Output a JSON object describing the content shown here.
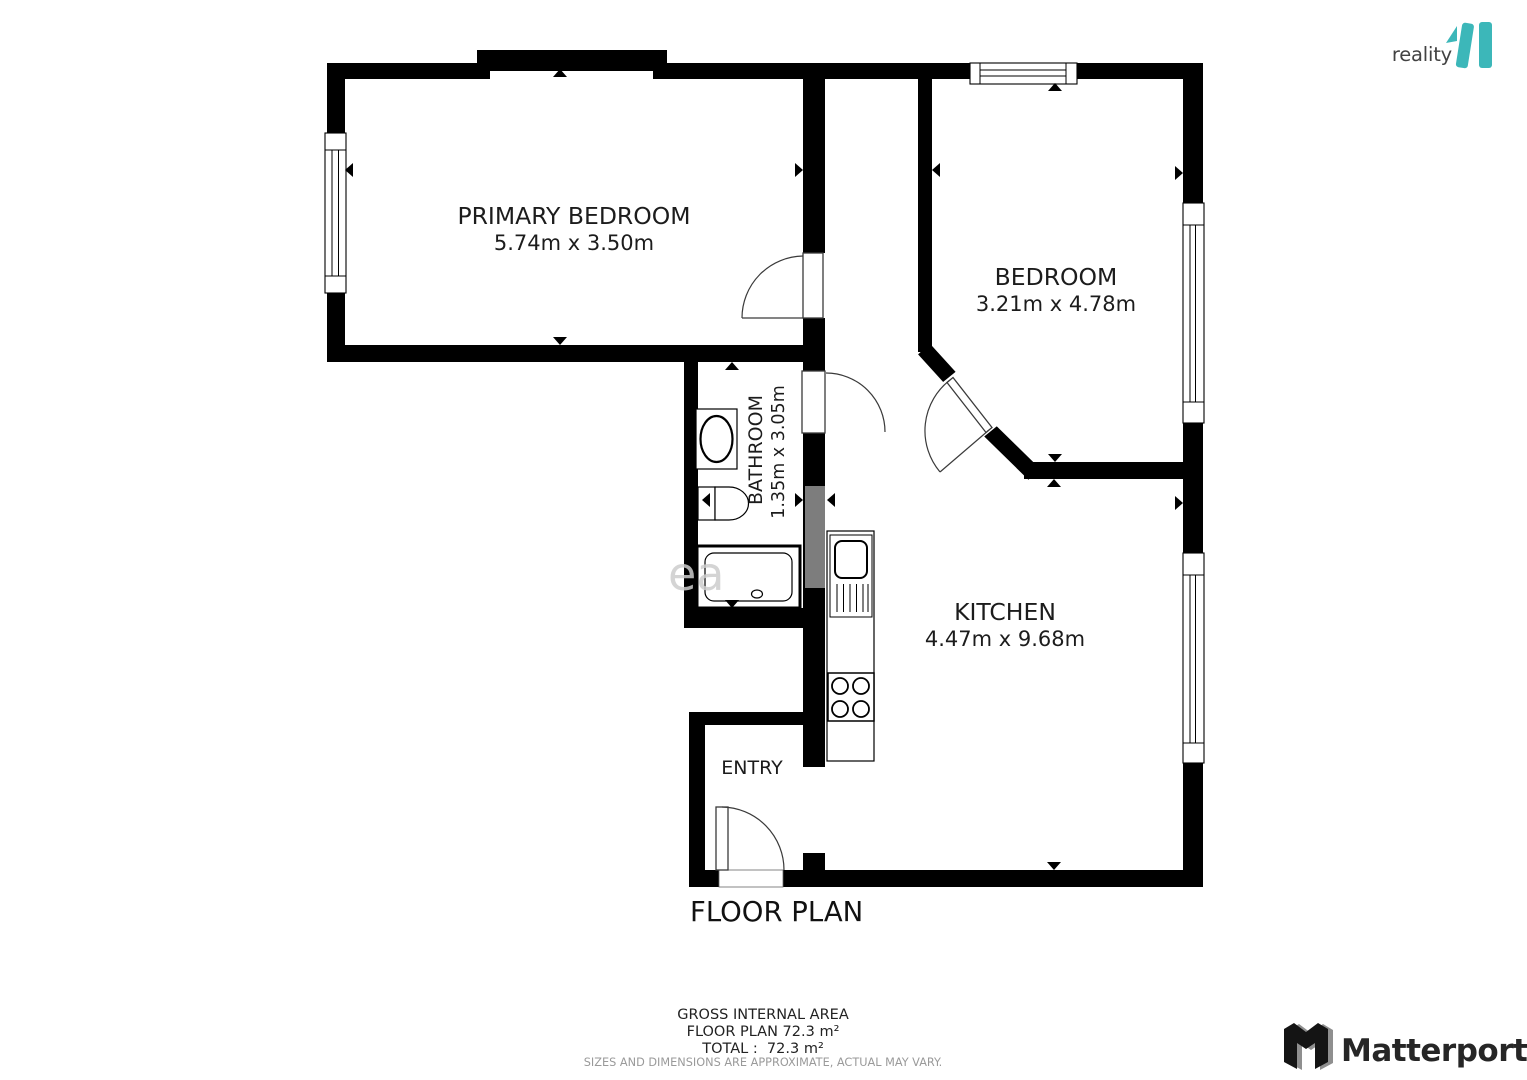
{
  "branding": {
    "reality": {
      "text": "reality",
      "accent": "11",
      "accent_color": "#3cb7b9"
    },
    "matterport": {
      "text": "Matterport"
    }
  },
  "plan": {
    "title": "FLOOR PLAN",
    "watermark_fragment": "ea",
    "rooms": {
      "primary_bedroom": {
        "name": "PRIMARY BEDROOM",
        "dims": "5.74m x 3.50m"
      },
      "bedroom": {
        "name": "BEDROOM",
        "dims": "3.21m x 4.78m"
      },
      "bathroom": {
        "name": "BATHROOM",
        "dims": "1.35m x 3.05m"
      },
      "kitchen": {
        "name": "KITCHEN",
        "dims": "4.47m x 9.68m"
      },
      "entry": {
        "name": "ENTRY"
      }
    }
  },
  "summary": {
    "gross_line": "GROSS INTERNAL AREA",
    "floor_line": "FLOOR PLAN 72.3 m²",
    "total_line": "TOTAL :  72.3 m²",
    "disclaimer": "SIZES AND DIMENSIONS ARE APPROXIMATE, ACTUAL MAY VARY."
  }
}
